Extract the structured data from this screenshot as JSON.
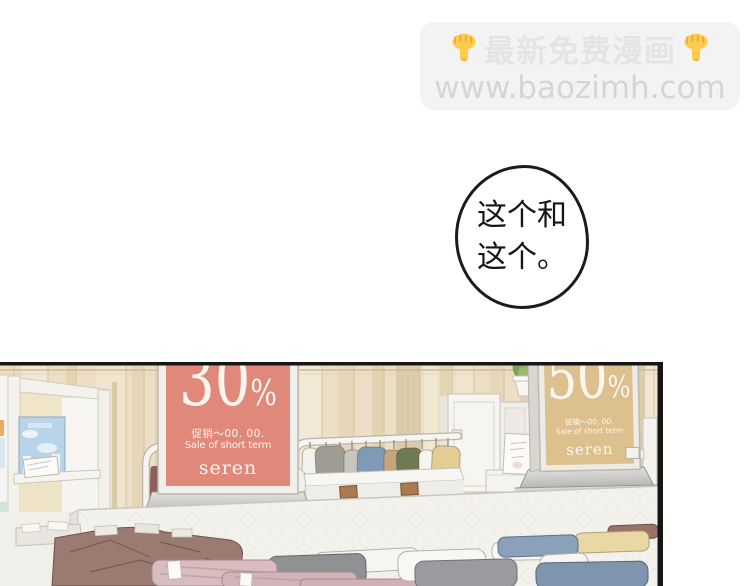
{
  "banner": {
    "headline": "最新免费漫画",
    "url": "www.baozimh.com",
    "hand_icon": "backhand-index-pointing-down",
    "bg_color": "#f3f3f3",
    "headline_color": "#e4e4e4",
    "url_color": "#d5d5d5",
    "hand_color": "#ffcb4c"
  },
  "speech_bubble": {
    "line1": "这个和",
    "line2": "这个。"
  },
  "panel": {
    "signs": [
      {
        "percent": "30",
        "percent_sign": "%",
        "promo_cn": "促销～00. 00.",
        "promo_en": "Sale of short term",
        "brand": "seren",
        "bg_color": "#e0897b"
      },
      {
        "percent": "50",
        "percent_sign": "%",
        "promo_cn": "促销～00. 00.",
        "promo_en": "Sale of short term",
        "brand": "seren",
        "bg_color": "#dcc18f"
      }
    ],
    "palette": {
      "wall": "#ecdfc5",
      "partition": "#f2f1ec",
      "poster_sky": "#b9d3e8",
      "plant_green": "#7da05a",
      "maroon_clothes": "#9b7a72",
      "panel_border": "#1a1a1a"
    }
  }
}
